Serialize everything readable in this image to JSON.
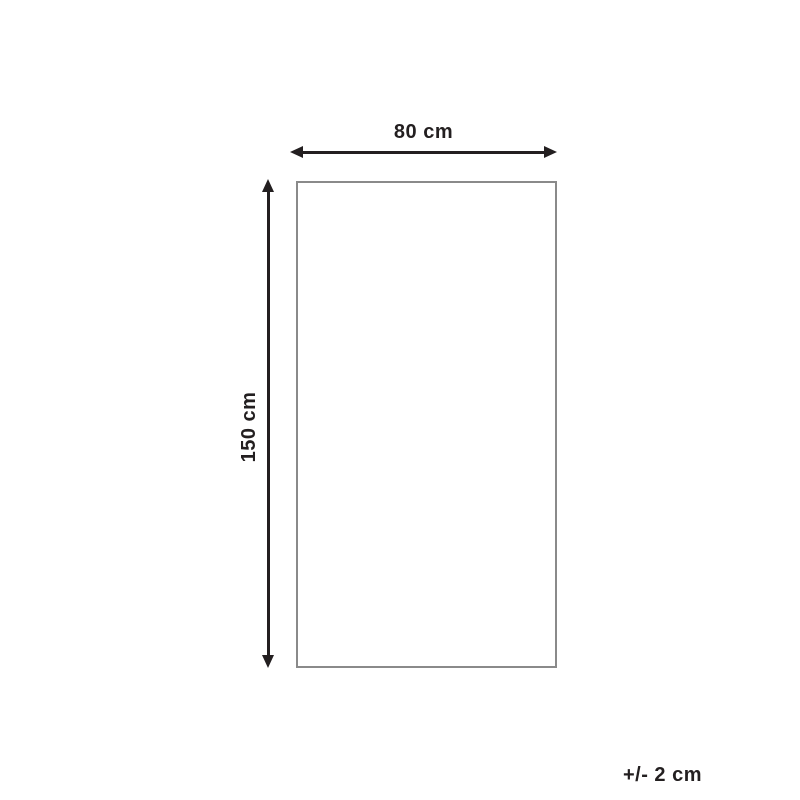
{
  "diagram": {
    "width_label": "80 cm",
    "height_label": "150 cm",
    "tolerance_label": "+/- 2 cm",
    "dimensions": {
      "width_cm": 80,
      "height_cm": 150,
      "tolerance_cm": 2,
      "unit": "cm"
    }
  },
  "colors": {
    "background": "#ffffff",
    "arrow": "#231f20",
    "text": "#231f20",
    "outline": "#8a8a8a"
  }
}
